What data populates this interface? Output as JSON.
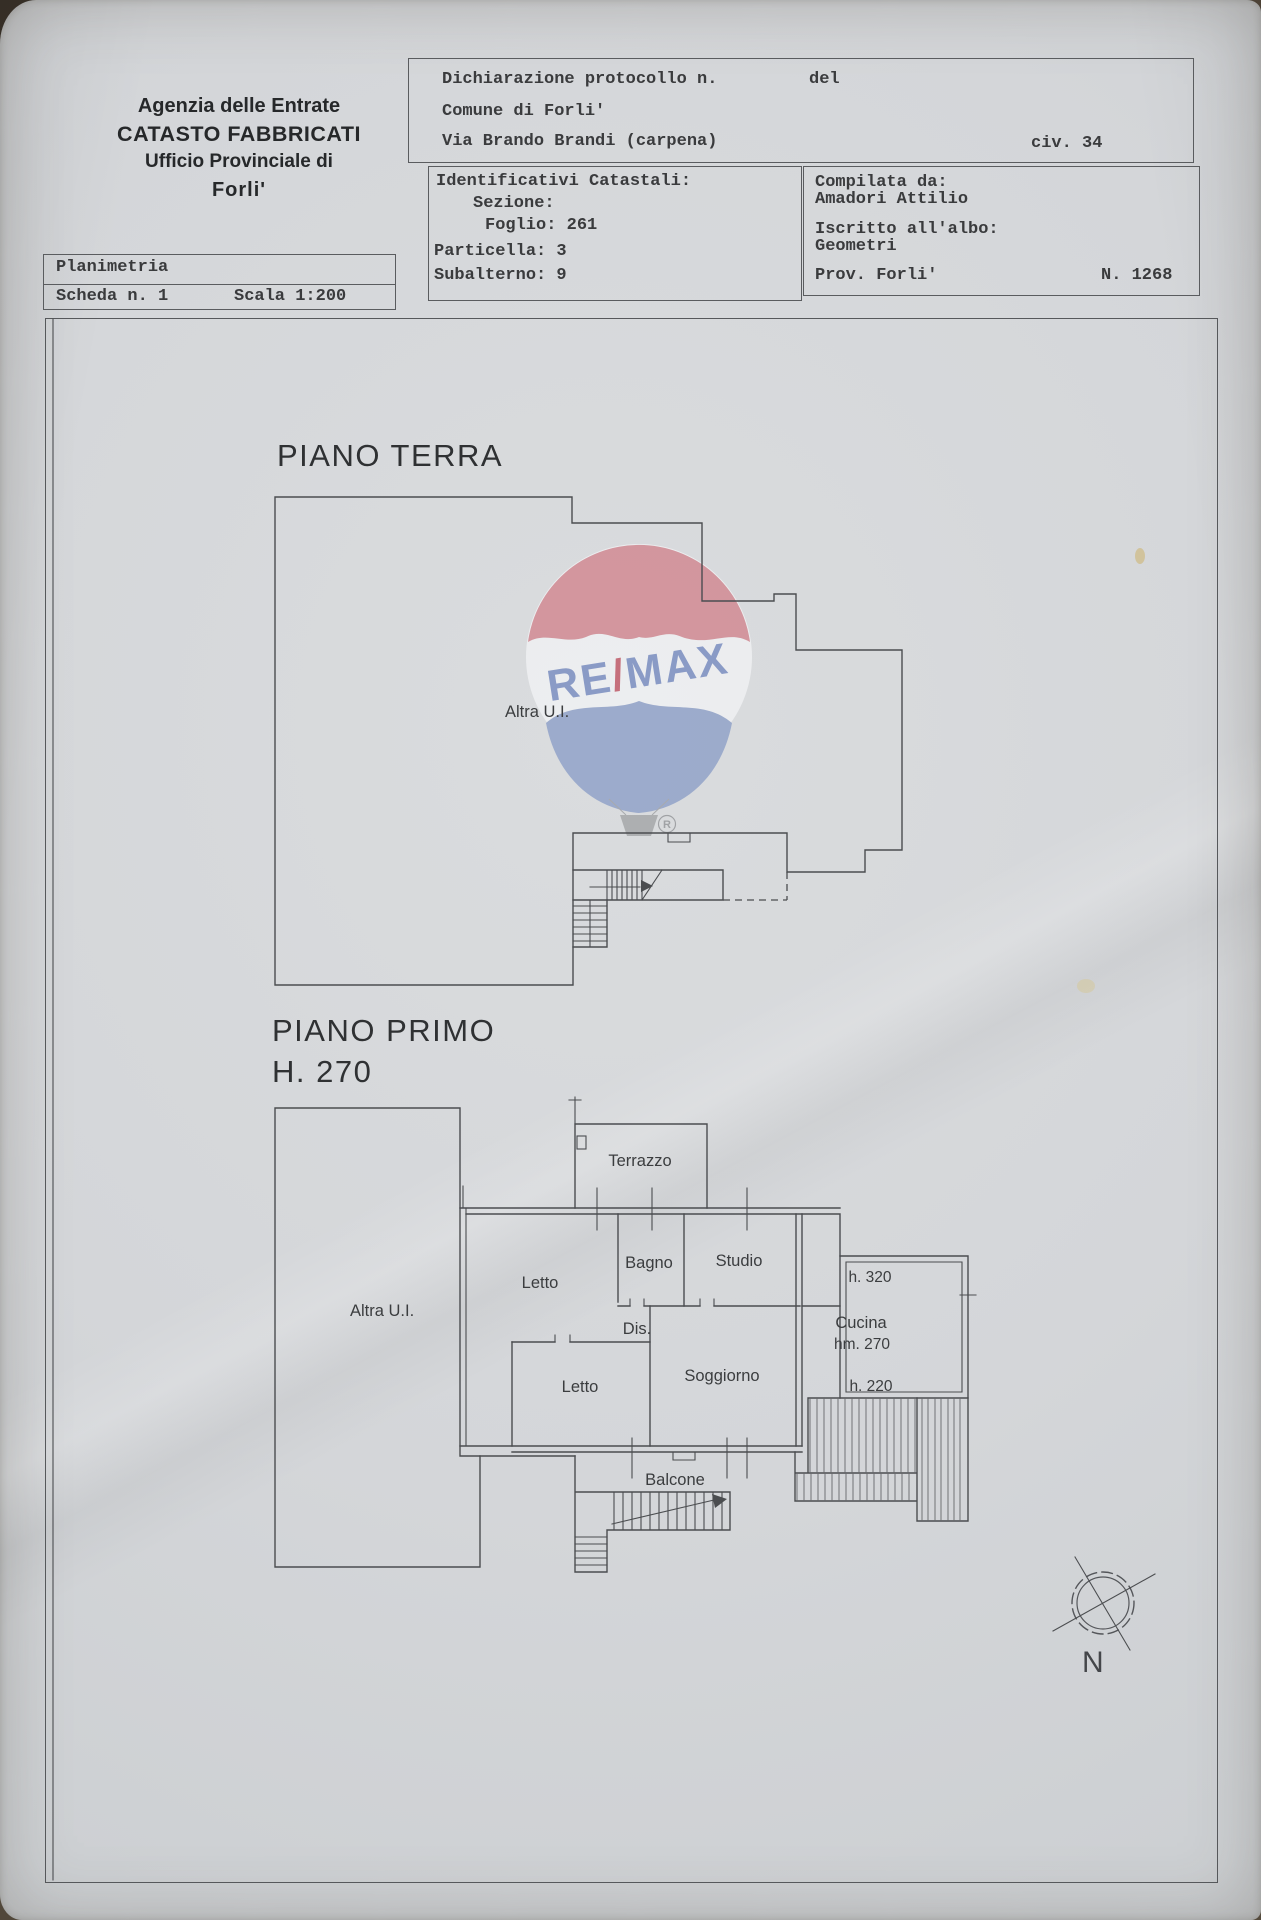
{
  "header": {
    "line1": "Agenzia delle Entrate",
    "line2": "CATASTO FABBRICATI",
    "line3": "Ufficio Provinciale di",
    "line4": "Forli'"
  },
  "boxes": {
    "declaration": {
      "protocol_label": "Dichiarazione protocollo n.",
      "del_label": "del",
      "comune": "Comune di Forli'",
      "address": "Via Brando Brandi (carpena)",
      "civic": "civ. 34"
    },
    "cadastral": {
      "title": "Identificativi Catastali:",
      "sezione": "Sezione:",
      "foglio": "Foglio: 261",
      "particella": "Particella: 3",
      "subalterno": "Subalterno: 9"
    },
    "compiler": {
      "compilata_label": "Compilata da:",
      "name": "Amadori Attilio",
      "albo_label": "Iscritto all'albo:",
      "albo_value": "Geometri",
      "prov": "Prov. Forli'",
      "number": "N. 1268"
    },
    "plan_card": {
      "title": "Planimetria",
      "scheda": "Scheda n. 1",
      "scala": "Scala 1:200"
    }
  },
  "ground_floor": {
    "title": "PIANO TERRA",
    "label_altra_ui": "Altra U.I."
  },
  "first_floor": {
    "title": "PIANO PRIMO",
    "subtitle": "H. 270",
    "label_altra_ui": "Altra U.I.",
    "rooms": {
      "terrazzo": "Terrazzo",
      "letto1": "Letto",
      "bagno": "Bagno",
      "studio": "Studio",
      "dis": "Dis.",
      "letto2": "Letto",
      "soggiorno": "Soggiorno",
      "cucina": "Cucina",
      "balcone": "Balcone"
    },
    "heights": {
      "h320": "h. 320",
      "hm270": "hm. 270",
      "h220": "h. 220"
    }
  },
  "watermark": {
    "re": "RE",
    "slash": "/",
    "max": "MAX",
    "registered": "R",
    "colors": {
      "red": "#d28b94",
      "blue": "#92a3c9",
      "text_blue": "#7d90c2",
      "slash_red": "#c25e6b",
      "band_white": "#f2f3f5",
      "basket_gray": "#a6a8aa"
    }
  },
  "compass": {
    "north": "N"
  }
}
